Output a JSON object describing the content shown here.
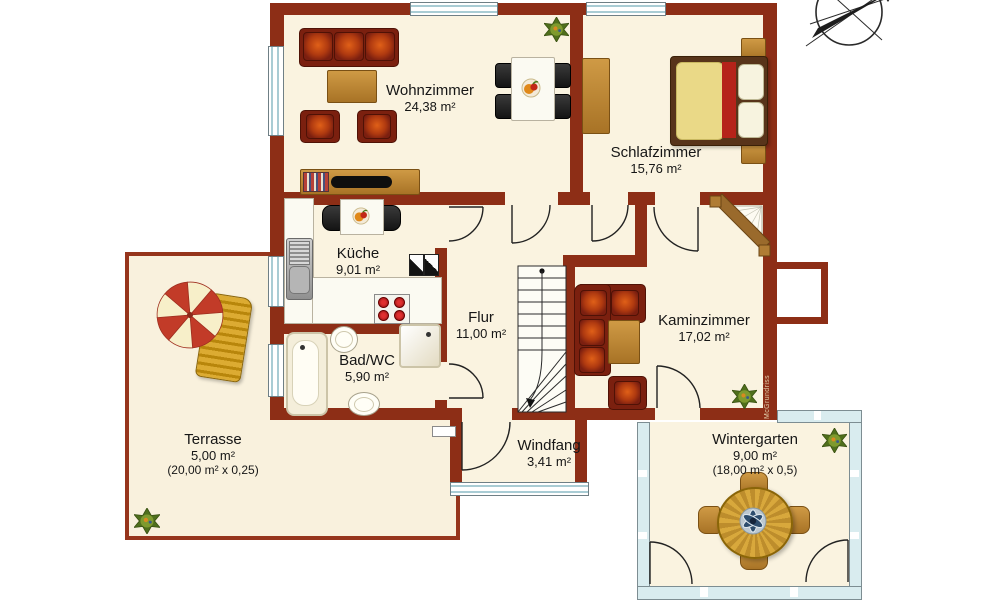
{
  "plan": {
    "type": "floorplan",
    "language": "de",
    "watermark": "McGrundriss",
    "compass_icon": "north-arrow-compass",
    "colors": {
      "wall": "#8d2e16",
      "floor": "#faf3e0",
      "terrace_border": "#96351c",
      "upholstery": "#7b200f",
      "upholstery_accent": "#e06018",
      "wood": "#c08f3f",
      "window_glass": "#a9ccd4",
      "text": "#161616"
    }
  },
  "rooms": {
    "wohnzimmer": {
      "name": "Wohnzimmer",
      "area": "24,38 m²",
      "furniture": [
        "sofa",
        "coffee-table",
        "armchair",
        "armchair",
        "tv-sideboard",
        "dining-table",
        "dining-chairs",
        "plant"
      ]
    },
    "schlafzimmer": {
      "name": "Schlafzimmer",
      "area": "15,76 m²",
      "furniture": [
        "double-bed",
        "nightstand",
        "nightstand",
        "wardrobe"
      ]
    },
    "kueche": {
      "name": "Küche",
      "area": "9,01 m²",
      "furniture": [
        "kitchen-table",
        "chairs",
        "sink",
        "counter",
        "stove",
        "appliance"
      ]
    },
    "flur": {
      "name": "Flur",
      "area": "11,00 m²",
      "furniture": [
        "staircase"
      ]
    },
    "kaminzimmer": {
      "name": "Kaminzimmer",
      "area": "17,02 m²",
      "furniture": [
        "corner-sofa",
        "coffee-table",
        "armchair",
        "fireplace",
        "plant"
      ]
    },
    "bad": {
      "name": "Bad/WC",
      "area": "5,90 m²",
      "furniture": [
        "bathtub",
        "wash-basin",
        "shower",
        "toilet"
      ]
    },
    "windfang": {
      "name": "Windfang",
      "area": "3,41 m²",
      "furniture": []
    },
    "terrasse": {
      "name": "Terrasse",
      "area": "5,00 m²",
      "note": "(20,00 m² x 0,25)",
      "furniture": [
        "parasol",
        "sun-lounger",
        "plant"
      ]
    },
    "wintergarten": {
      "name": "Wintergarten",
      "area": "9,00 m²",
      "note": "(18,00 m² x 0,5)",
      "furniture": [
        "round-table",
        "chairs",
        "plant"
      ]
    }
  }
}
